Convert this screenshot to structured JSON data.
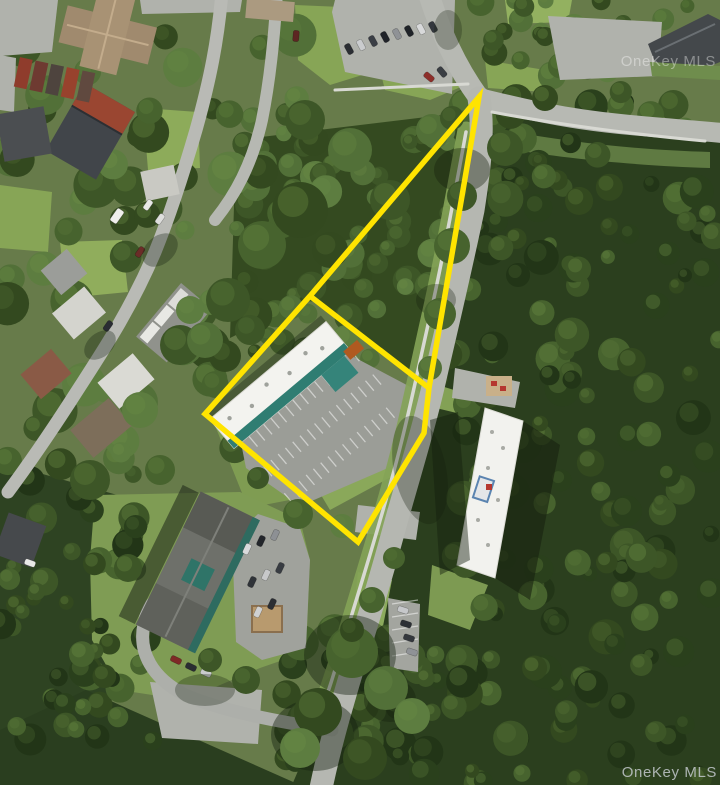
{
  "photo": {
    "description": "Aerial satellite photo of a wooded suburban parcel outlined with a yellow property boundary",
    "watermark_top_right": "OneKey MLS",
    "watermark_bottom_right": "OneKey MLS"
  },
  "boundary": {
    "color": "#FFE400",
    "stroke_width": "5.5",
    "outer_points": "479,97 429,388 424,433 358,542 205,414 310,296",
    "divider_points": "310,296 429,388"
  }
}
